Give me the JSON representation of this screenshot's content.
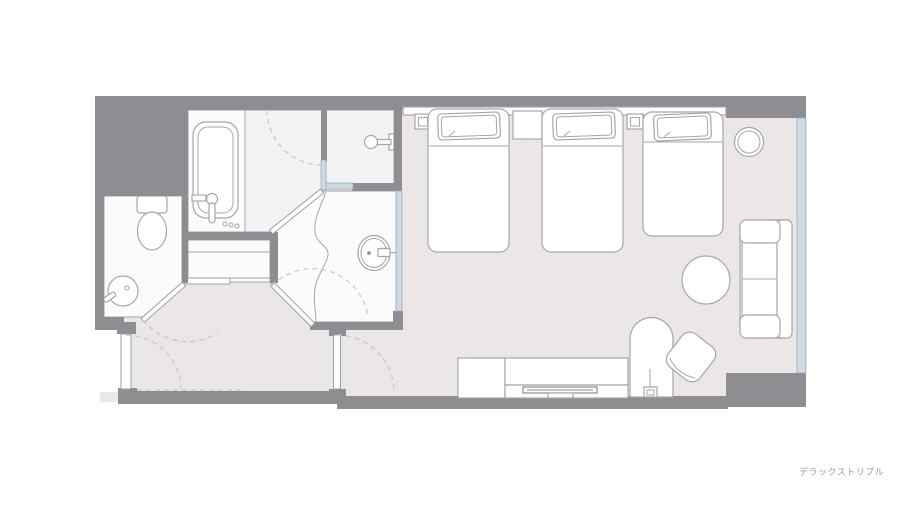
{
  "caption": "デラックストリプル",
  "colors": {
    "wall": "#8e8e92",
    "floor": "#eae7e6",
    "room": "#fbfbfb",
    "wetroom": "#f1f3f5",
    "glass": "#cddbe4",
    "outline": "#a6a6a6",
    "dash": "#ccc6c0",
    "text": "#9a9a9a"
  },
  "elements": {
    "rooms": [
      "bathroom",
      "shower-room",
      "toilet-room",
      "vanity-room",
      "closet",
      "entry-hall",
      "bedroom"
    ],
    "fixtures": [
      "bathtub",
      "bathtub-faucet",
      "shower-head",
      "toilet",
      "corner-washbasin",
      "vanity-sink",
      "vanity-counter"
    ],
    "furniture": [
      "headboard-panel",
      "bedside-lamp-left",
      "bedside-lamp-right",
      "nightstand",
      "bed-1",
      "bed-2",
      "bed-3",
      "round-stool",
      "sofa",
      "round-table",
      "desk",
      "desk-lamp",
      "desk-chair",
      "tv-cabinet",
      "tv-board",
      "tv"
    ],
    "openings": [
      "entrance-door",
      "toilet-door",
      "vanity-door",
      "bedroom-door",
      "bathroom-door-swing",
      "window"
    ]
  }
}
